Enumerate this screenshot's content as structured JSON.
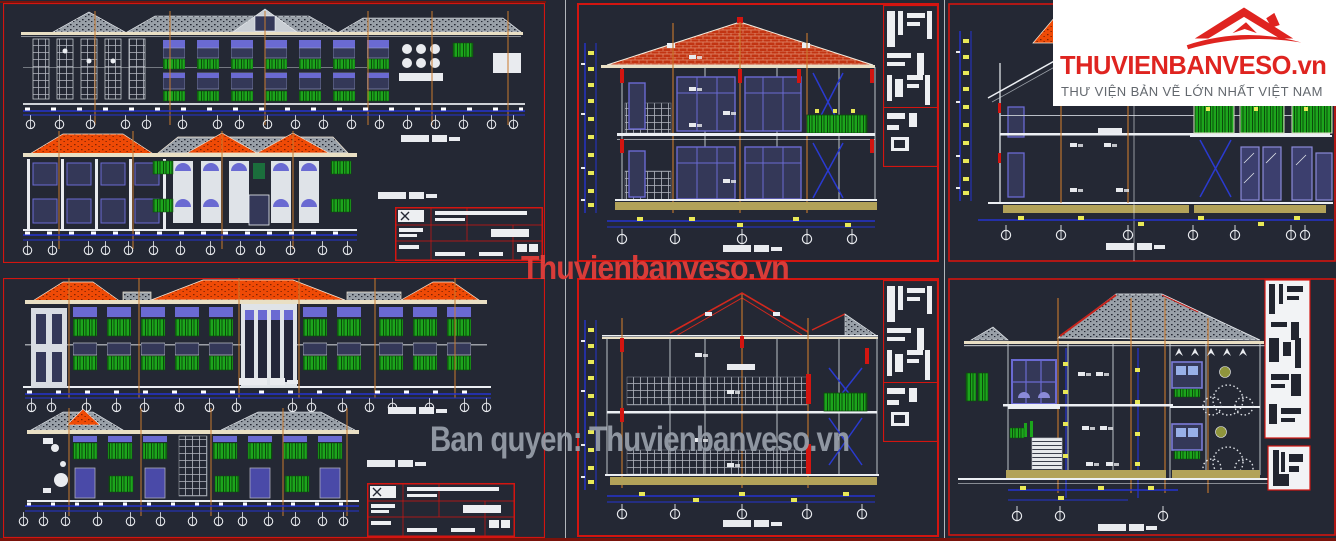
{
  "logo": {
    "brand": "THUVIENBANVESO.vn",
    "tagline": "THƯ VIỆN BẢN VẼ LỚN NHẤT VIỆT NAM",
    "icon": "red-roof-house-icon"
  },
  "watermarks": {
    "center": "Thuvienbanveso.vn",
    "bottom": "Ban quyen: Thuvienbanveso.vn"
  },
  "colors": {
    "bg": "#242834",
    "red": "#d31510",
    "darkred": "#7a130b",
    "rooforange": "#ef4a06",
    "roofgray": "#99a0a8",
    "rooftile": "#c23412",
    "cream": "#e9dfc4",
    "green": "#1ca51c",
    "dimblue": "#2433cf",
    "yellow": "#e9e957",
    "tan": "#b2a259",
    "gridorange": "#c97a2e",
    "white": "#eceff3",
    "winblue": "#6a6ad2",
    "winfill": "#343858",
    "logored": "#df2420",
    "wmred": "#e63e3a",
    "wmgray": "#99a0ab",
    "tagline": "#63686e"
  }
}
